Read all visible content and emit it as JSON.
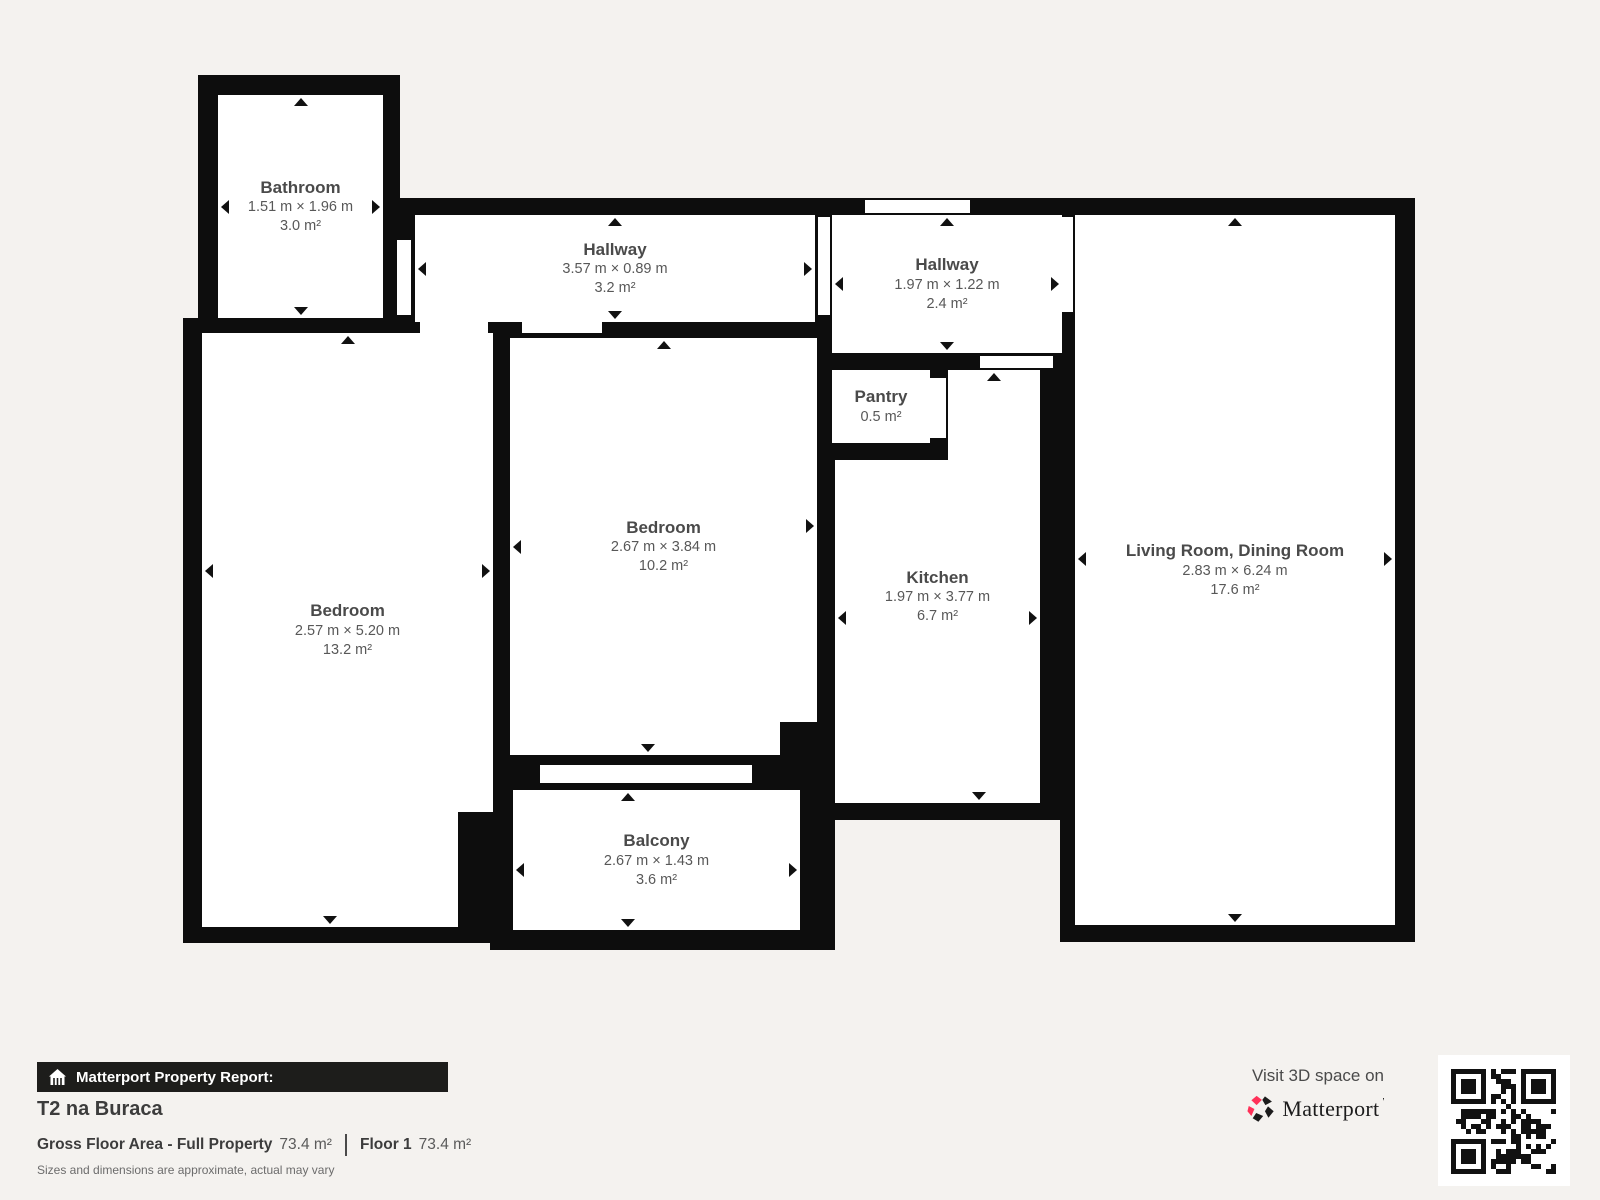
{
  "plan": {
    "rooms": [
      {
        "name": "Bathroom",
        "dimensions": "1.51 m × 1.96 m",
        "area": "3.0 m²"
      },
      {
        "name": "Hallway",
        "dimensions": "3.57 m × 0.89 m",
        "area": "3.2 m²"
      },
      {
        "name": "Hallway",
        "dimensions": "1.97 m × 1.22 m",
        "area": "2.4 m²"
      },
      {
        "name": "Pantry",
        "area": "0.5 m²"
      },
      {
        "name": "Bedroom",
        "dimensions": "2.57 m × 5.20 m",
        "area": "13.2 m²"
      },
      {
        "name": "Bedroom",
        "dimensions": "2.67 m × 3.84 m",
        "area": "10.2 m²"
      },
      {
        "name": "Kitchen",
        "dimensions": "1.97 m × 3.77 m",
        "area": "6.7 m²"
      },
      {
        "name": "Living Room, Dining Room",
        "dimensions": "2.83 m × 6.24 m",
        "area": "17.6 m²"
      },
      {
        "name": "Balcony",
        "dimensions": "2.67 m × 1.43 m",
        "area": "3.6 m²"
      }
    ]
  },
  "report": {
    "bar_label": "Matterport Property Report:",
    "property_title": "T2 na Buraca",
    "gross_label": "Gross Floor Area - Full Property",
    "gross_value": "73.4 m²",
    "floor_label": "Floor 1",
    "floor_value": "73.4 m²",
    "disclaimer": "Sizes and dimensions are approximate, actual may vary"
  },
  "promo": {
    "visit_text": "Visit 3D space on",
    "brand": "Matterport"
  },
  "colors": {
    "background": "#f4f2ef",
    "wall": "#0d0d0d",
    "room_fill": "#ffffff",
    "label_text": "#4a4a4a",
    "brand_pink": "#ff3158"
  }
}
